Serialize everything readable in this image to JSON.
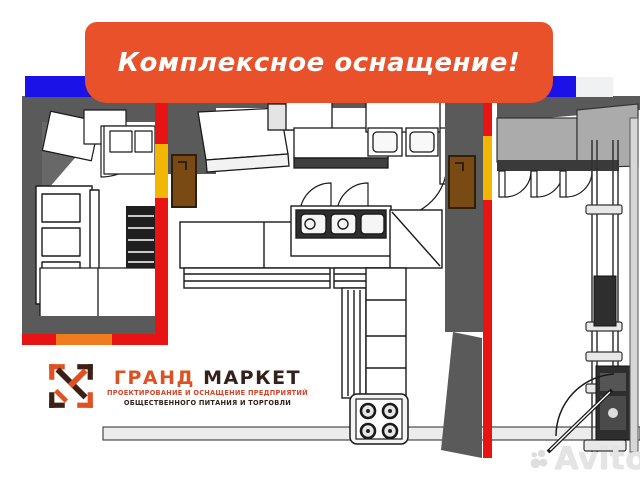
{
  "banner": {
    "label": "Комплексное оснащение!"
  },
  "logo": {
    "icon": "grand-market-monogram-icon",
    "title_accent": "ГРАНД",
    "title_rest": "МАРКЕТ",
    "subtitle_line1": "ПРОЕКТИРОВАНИЕ И ОСНАЩЕНИЕ ПРЕДПРИЯТИЙ",
    "subtitle_line2": "ОБЩЕСТВЕННОГО ПИТАНИЯ И ТОРГОВЛИ"
  },
  "watermark": {
    "icon": "avito-circles-logo",
    "brand": "Avito"
  },
  "colors": {
    "banner_bg": "#E8512A",
    "banner_text": "#FFFFFF",
    "top_bar_blue": "#1B12E8",
    "wall_dark_gray": "#5A5A5A",
    "wall_red": "#E81414",
    "wall_yellow": "#F2B705",
    "wall_orange_segment": "#EF7D20",
    "door_brown": "#7A4A15",
    "counter_gray": "#ABABAB",
    "logo_orange": "#DF5122",
    "logo_dark_brown": "#33211A",
    "watermark_gray": "#E0E0E0"
  }
}
